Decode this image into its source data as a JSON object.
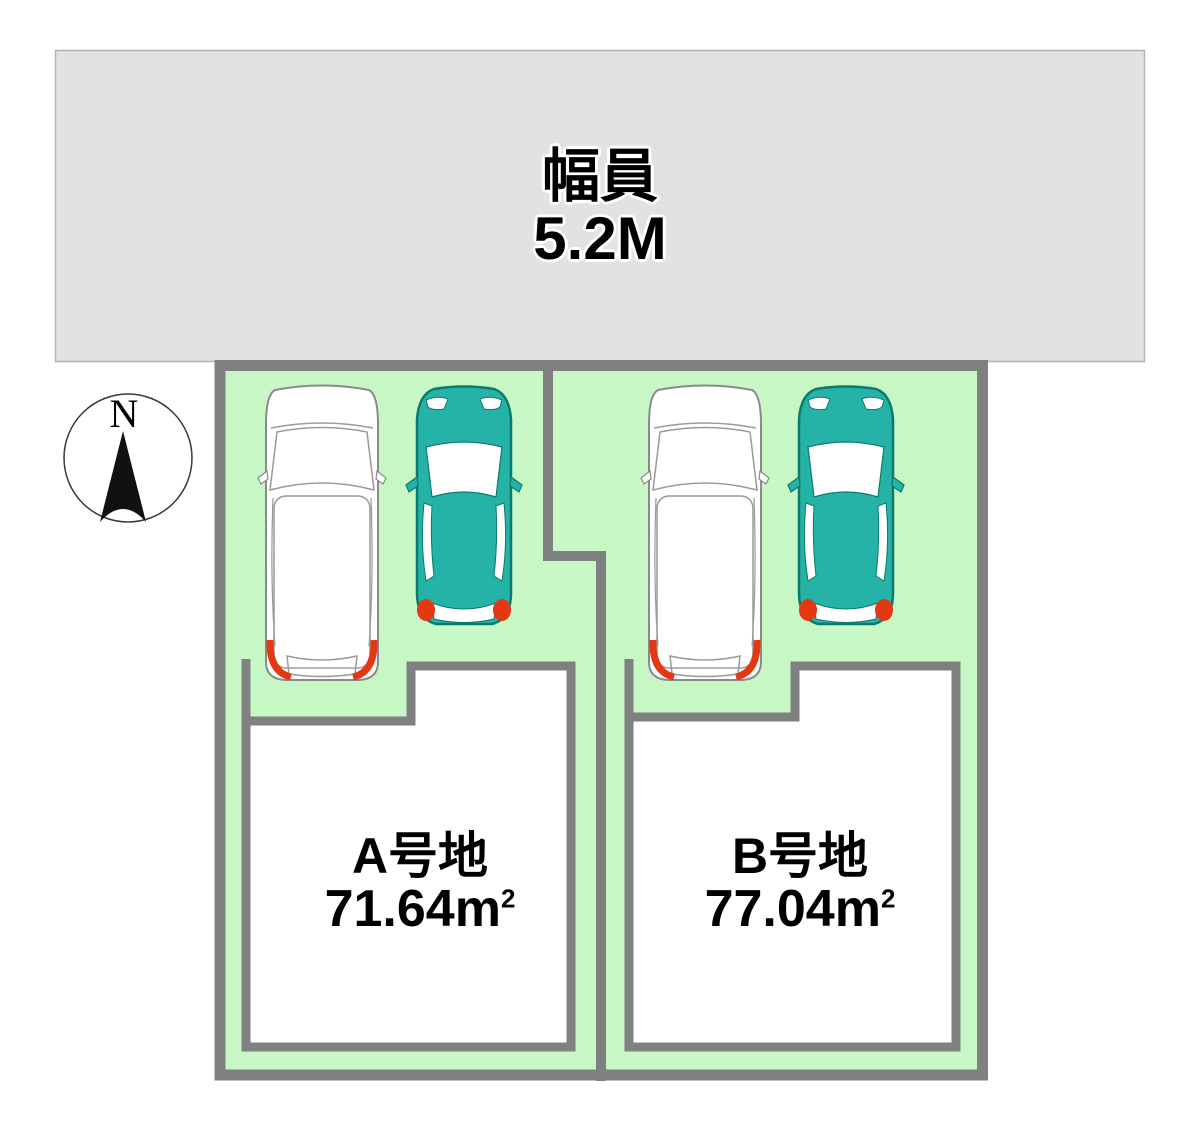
{
  "diagram": {
    "type": "residential-lot-site-plan"
  },
  "road": {
    "label_line1": "幅員",
    "label_line2": "5.2M"
  },
  "compass": {
    "north_label": "N"
  },
  "plots": [
    {
      "id": "A",
      "name_label": "A号地",
      "area_value": "71.64",
      "area_unit": "m",
      "area_superscript": "2",
      "cars": [
        "white-minivan",
        "teal-compact-car"
      ]
    },
    {
      "id": "B",
      "name_label": "B号地",
      "area_value": "77.04",
      "area_unit": "m",
      "area_superscript": "2",
      "cars": [
        "white-minivan",
        "teal-compact-car"
      ]
    }
  ],
  "colors": {
    "road_fill": "#e2e2e2",
    "plot_green": "#c8f7c6",
    "border_gray": "#808080",
    "building_fill": "#ffffff",
    "car_body_white": "#ffffff",
    "car_body_teal": "#26b3a7",
    "car_outline_teal": "#0b7a6e",
    "car_accent_red": "#e43814",
    "text_black": "#000000"
  }
}
